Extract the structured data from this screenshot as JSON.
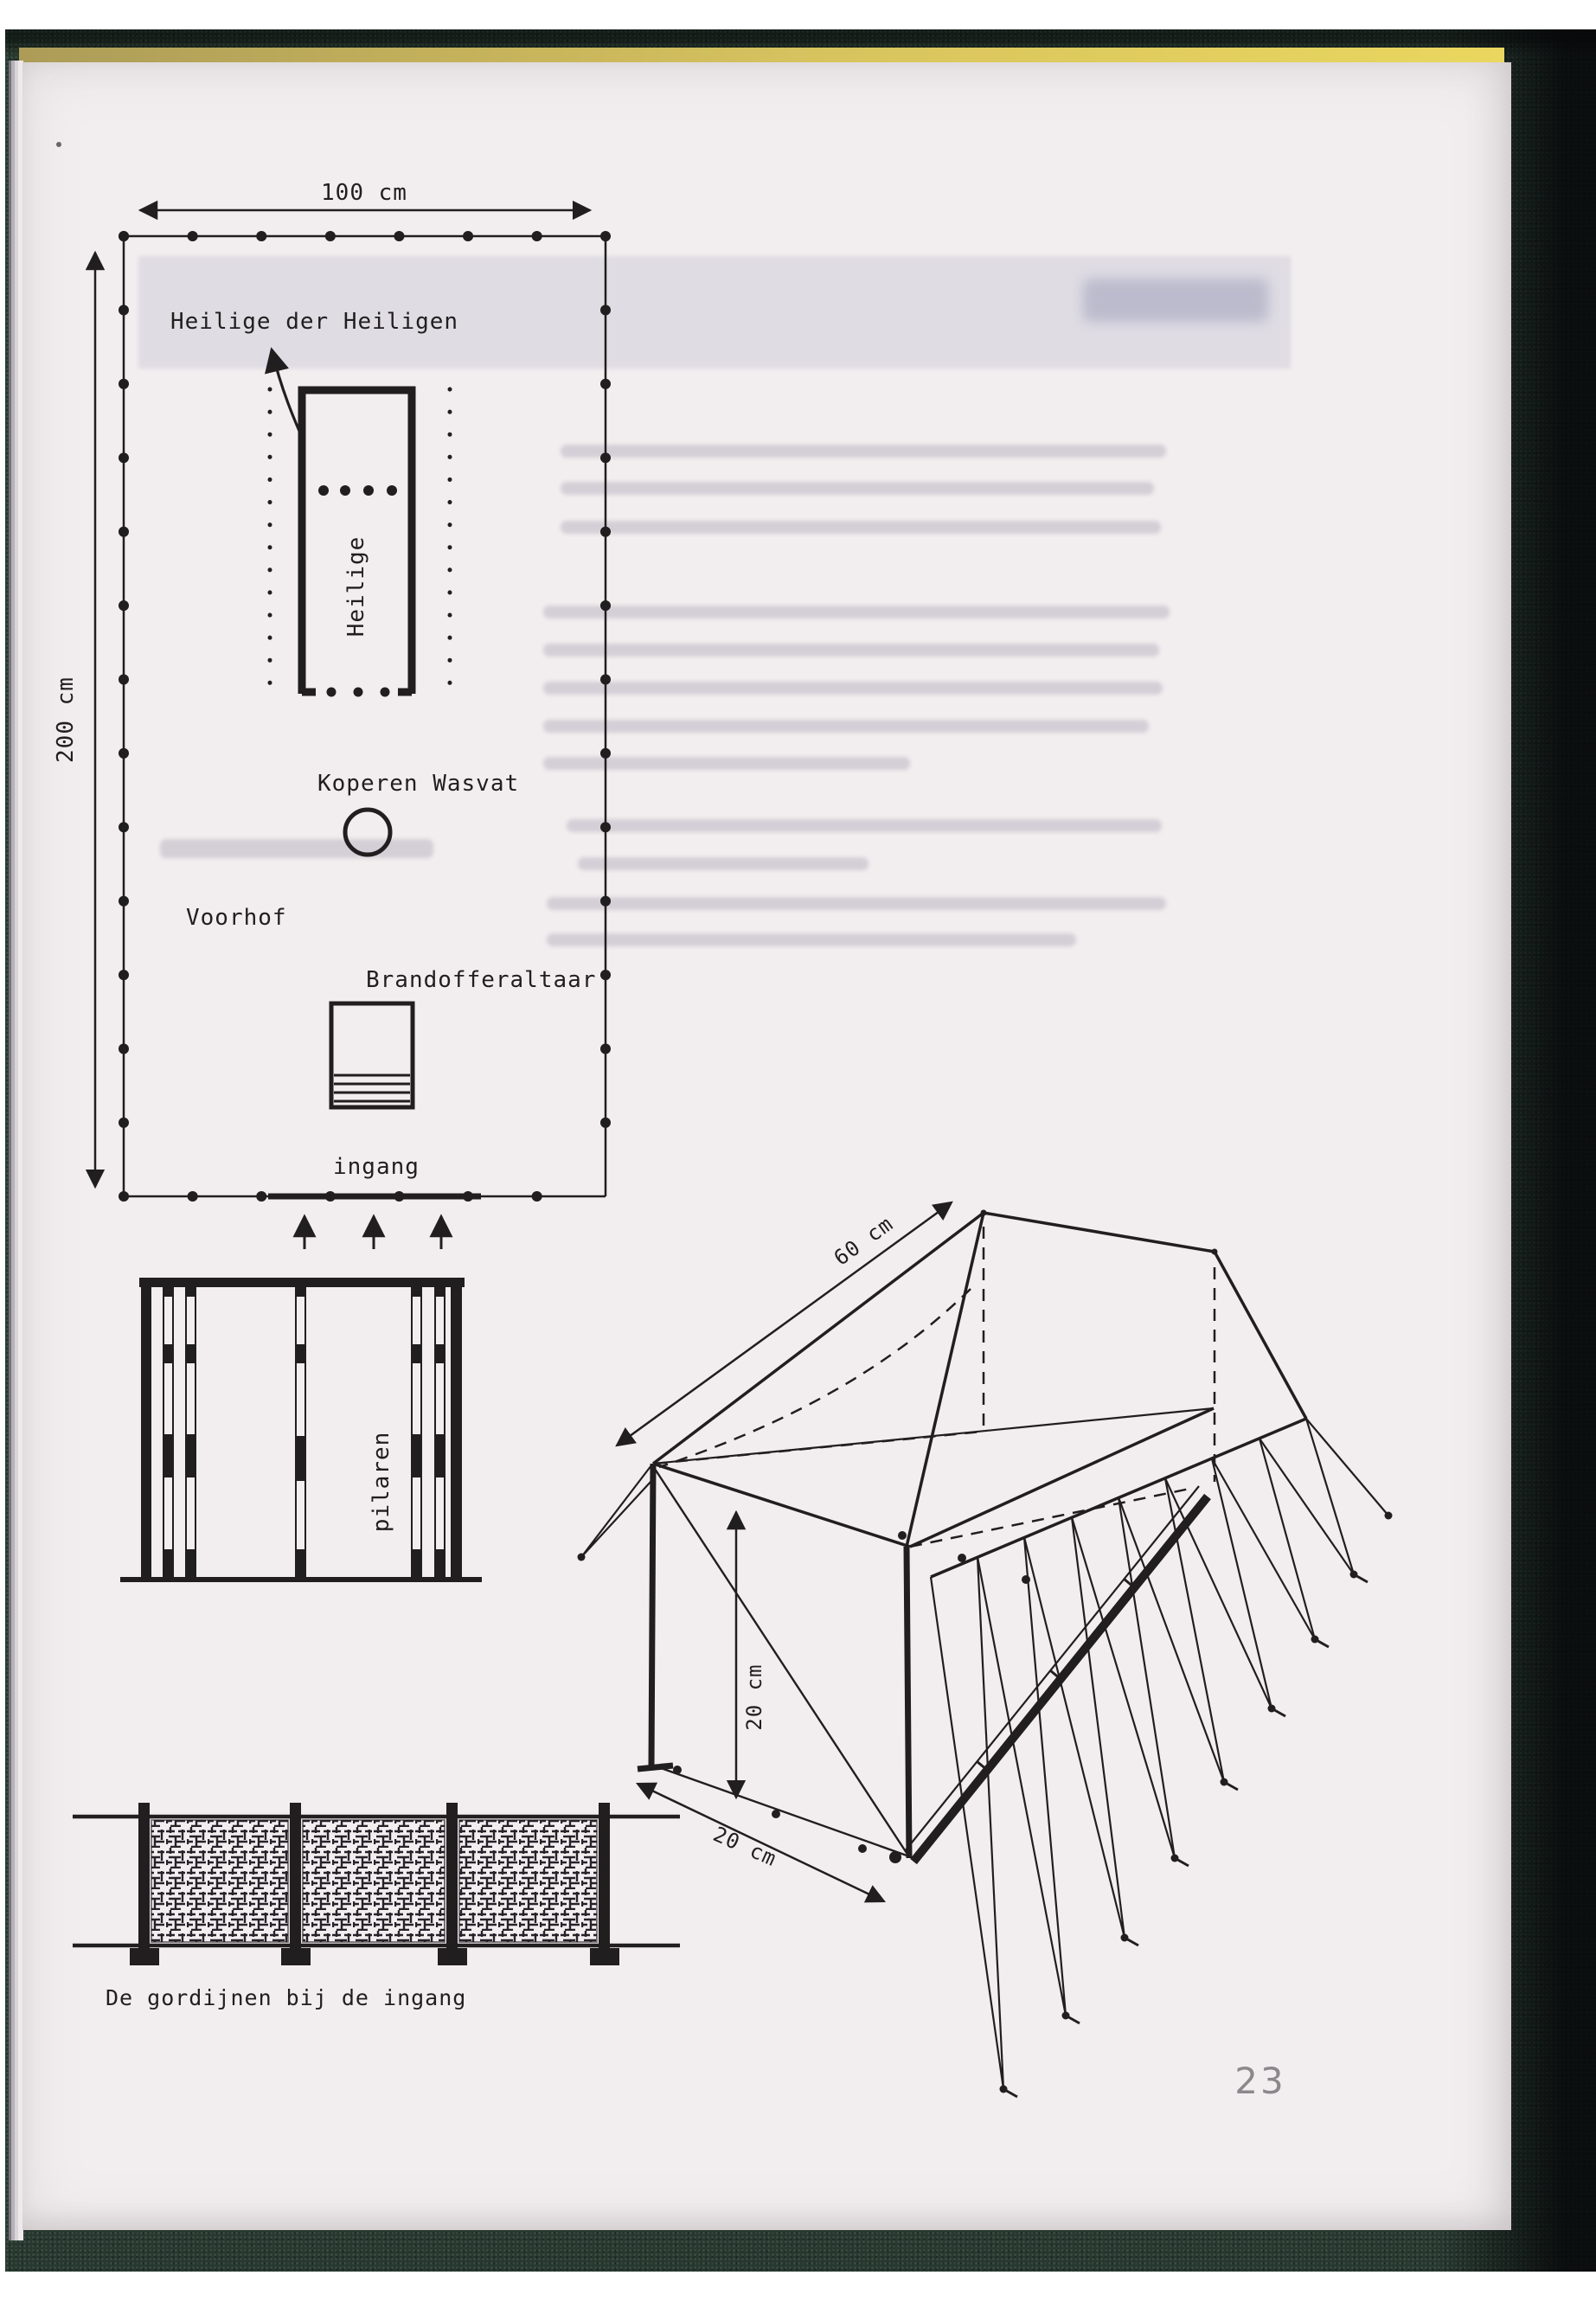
{
  "document": {
    "page_number": "23",
    "plan": {
      "width_label": "100 cm",
      "height_label": "200 cm",
      "label_holy_of_holies": "Heilige der Heiligen",
      "label_holy": "Heilige",
      "label_laver": "Koperen Wasvat",
      "label_court": "Voorhof",
      "label_altar": "Brandofferaltaar",
      "label_entrance": "ingang"
    },
    "boards": {
      "label": "pilaren"
    },
    "tent": {
      "length_label": "60 cm",
      "height_label": "20 cm",
      "depth_label": "20 cm"
    },
    "curtains": {
      "caption": "De gordijnen bij de ingang"
    }
  }
}
